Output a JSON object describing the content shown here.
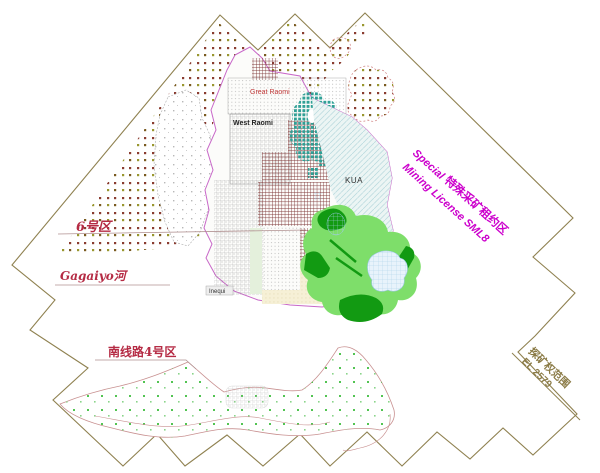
{
  "map": {
    "zones": {
      "zone6_label": "6号区",
      "river_label": "Gagaiyo河",
      "south_road_label": "南线路4号区",
      "kua_label": "KUA",
      "great_raomi_label": "Great Raomi",
      "west_raomi_label": "West Raomi",
      "village_label": "Inequi"
    },
    "sml": {
      "en_word": "Special",
      "zh": "特殊采矿租约区",
      "line2": "Mining License SML8"
    },
    "el": {
      "zh": "探矿权范围",
      "code": "EL 2579"
    },
    "colors": {
      "boundary_olive": "#8f8150",
      "license_magenta": "#c868c8",
      "sml_text_magenta": "#cc00cc",
      "label_crimson": "#b52b44",
      "el_text_olive": "#8a7a45",
      "teal_region": "#2fa096",
      "green_dark": "#129a12",
      "green_light": "#7ede6a",
      "maroon_hatch": "#7c3434",
      "kua_fill": "#ecf5f4",
      "dot_brown": "#8a3c30",
      "dot_olive": "#99972f",
      "bottom_outline_pink": "#c89090"
    }
  }
}
